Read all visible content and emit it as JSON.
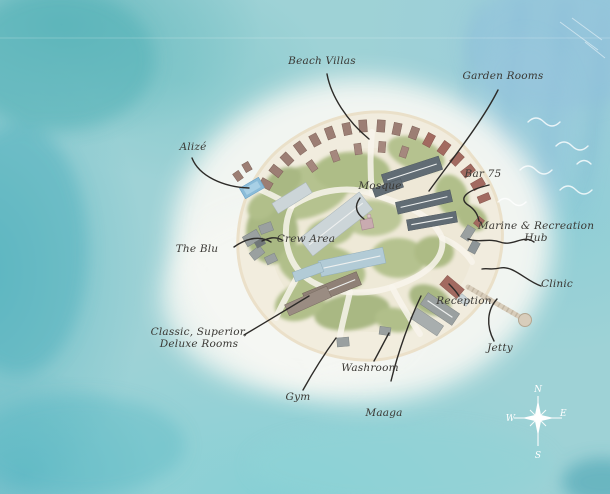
{
  "map": {
    "type": "island-resort-map",
    "style": "watercolor"
  },
  "labels": {
    "beach_villas": "Beach Villas",
    "garden_rooms": "Garden Rooms",
    "alize": "Alizé",
    "bar_75": "Bar 75",
    "mosque": "Mosque",
    "marine_recreation_hub": {
      "line1": "Marine & Recreation",
      "line2": "Hub"
    },
    "the_blu": "The Blu",
    "crew_area": "Crew Area",
    "clinic": "Clinic",
    "reception": "Reception",
    "jetty": "Jetty",
    "classic_superior_deluxe": {
      "line1": "Classic, Superior,",
      "line2": "Deluxe Rooms"
    },
    "washroom": "Washroom",
    "gym": "Gym",
    "maaga": "Maaga"
  },
  "compass": {
    "north": "N",
    "east": "E",
    "south": "S",
    "west": "W"
  },
  "colors": {
    "ocean_teal": "#64bcc0",
    "ocean_light_blue": "#b7d9e3",
    "lagoon_white": "#f6f7f3",
    "sand": "#f1ecdd",
    "vegetation": "#b2bf8a",
    "villa_roof": "#9c7e74",
    "garden_room_roof": "#a26a60",
    "block_roof_dark": "#616c74",
    "pool_blue": "#8abcd9",
    "label_ink": "#3a3834",
    "leader_line": "#2d2b28"
  }
}
